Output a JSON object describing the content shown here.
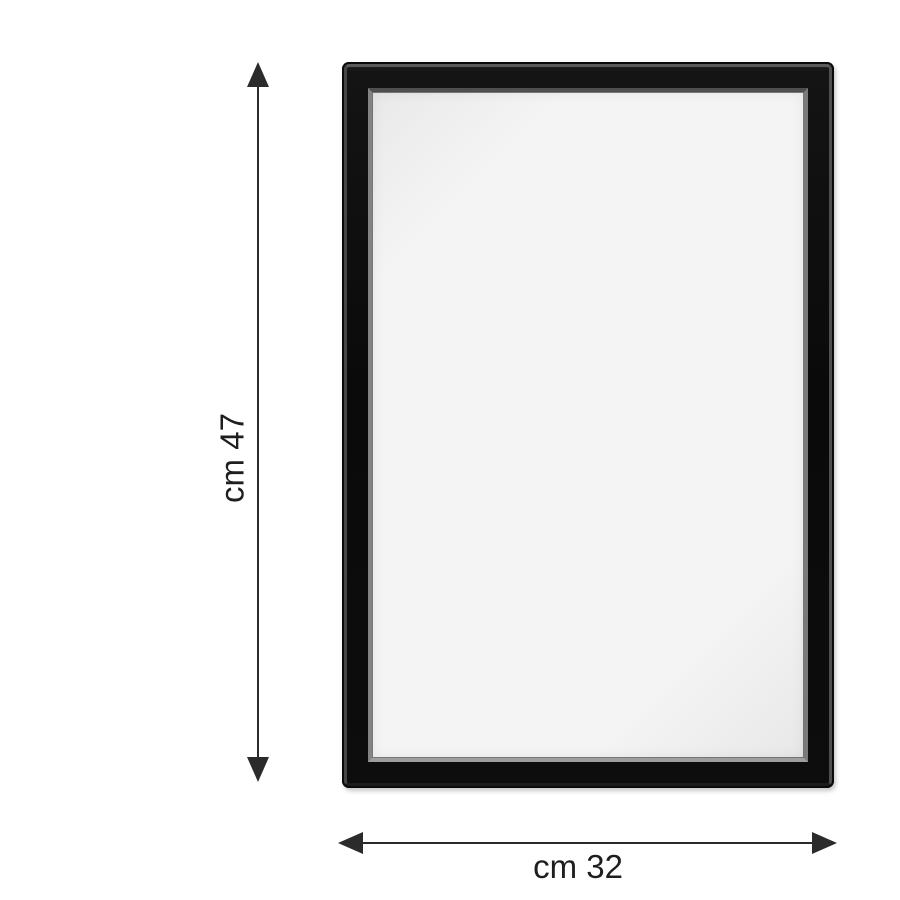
{
  "page": {
    "background_color": "#ffffff"
  },
  "frame": {
    "description": "black picture frame, front view, empty opening",
    "outer_color": "#0d0d0d",
    "bevel_highlight_color": "#5a5a5a",
    "inner_lip_color": "#8f8f8f",
    "opening_color": "#f2f2f2"
  },
  "dimensions": {
    "annotation_color": "#2b2b2b",
    "text_color": "#1e1e1e",
    "height": {
      "label": "cm 47",
      "unit": "cm",
      "value": 47
    },
    "width": {
      "label": "cm 32",
      "unit": "cm",
      "value": 32
    }
  }
}
